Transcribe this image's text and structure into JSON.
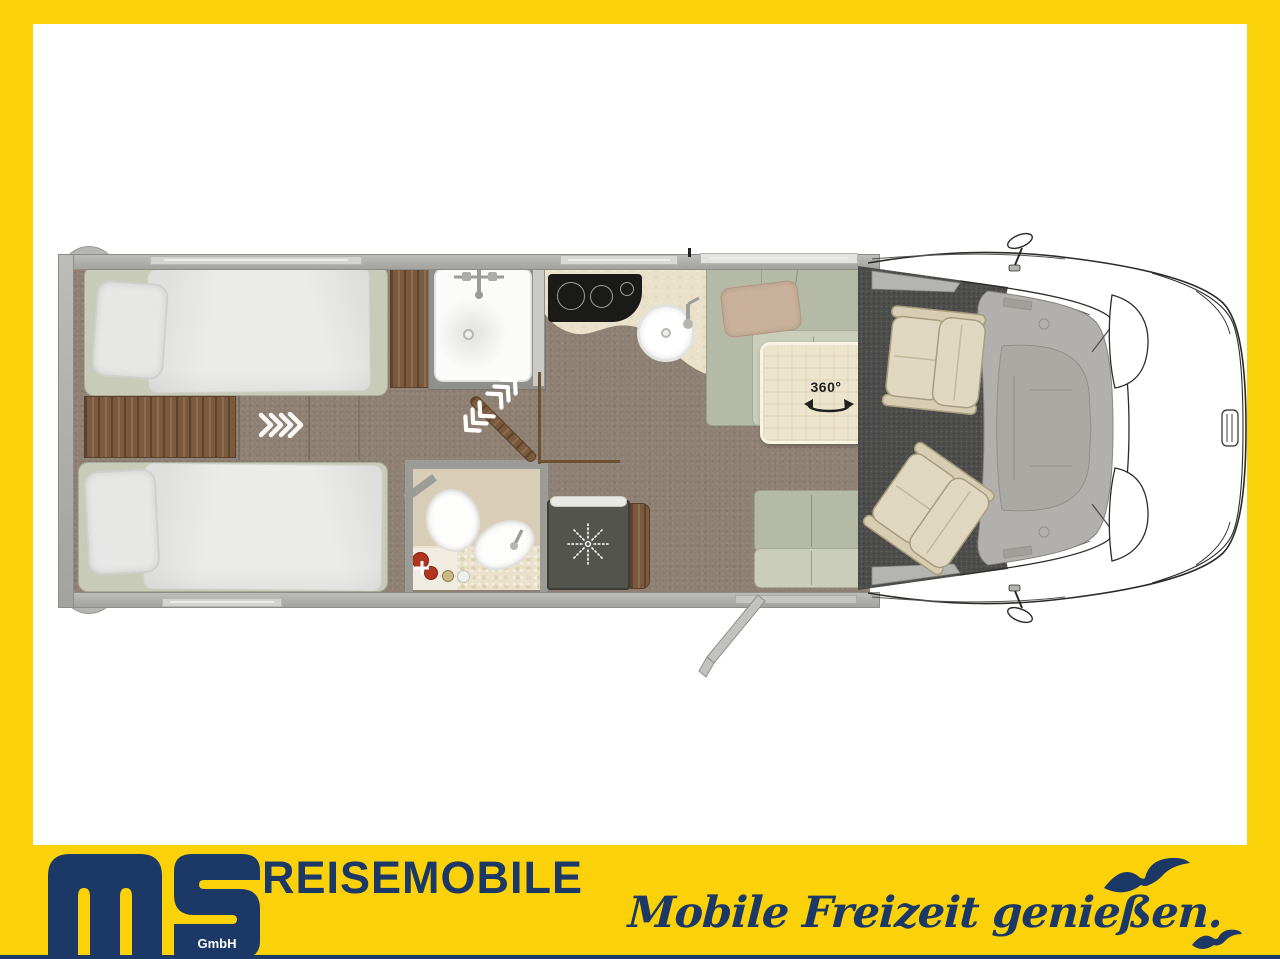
{
  "frame": {
    "brand_yellow": "#FBD20A",
    "brand_navy": "#1B3866"
  },
  "footer": {
    "logo": {
      "company": "ms",
      "suffix": "GmbH"
    },
    "wordmark": "REISEMOBILE",
    "slogan": "Mobile Freizeit genießen.",
    "icons": [
      "seagull-icon",
      "seagull-icon"
    ]
  },
  "floorplan": {
    "table_badge": "360°",
    "icons": [
      "swivel-arrow-icon",
      "slide-chevrons-icon",
      "sliding-door-chevrons-icon",
      "shower-faucet-icon",
      "kitchen-faucet-icon",
      "heater-fan-icon",
      "entry-door-icon",
      "side-mirror-icon"
    ],
    "areas": [
      "twin-single-bed-top",
      "twin-single-bed-bottom",
      "headboard-step",
      "wardrobe",
      "shower",
      "kitchen-hob",
      "kitchen-sink",
      "l-shaped-lounge",
      "swivel-table",
      "bathroom-toilet",
      "bathroom-basin",
      "heater-unit",
      "travel-bench",
      "driver-swivel-seat",
      "passenger-swivel-seat",
      "cab-carpet",
      "vehicle-front"
    ],
    "colors": {
      "floor": "#8E8073",
      "cab_carpet": "#4D4D4B",
      "wood": "#7B593C",
      "upholstery": "#C9CDBA",
      "counter": "#EAE1CA",
      "cooktop": "#1A1A19",
      "wall": "#A9A9A5"
    }
  }
}
